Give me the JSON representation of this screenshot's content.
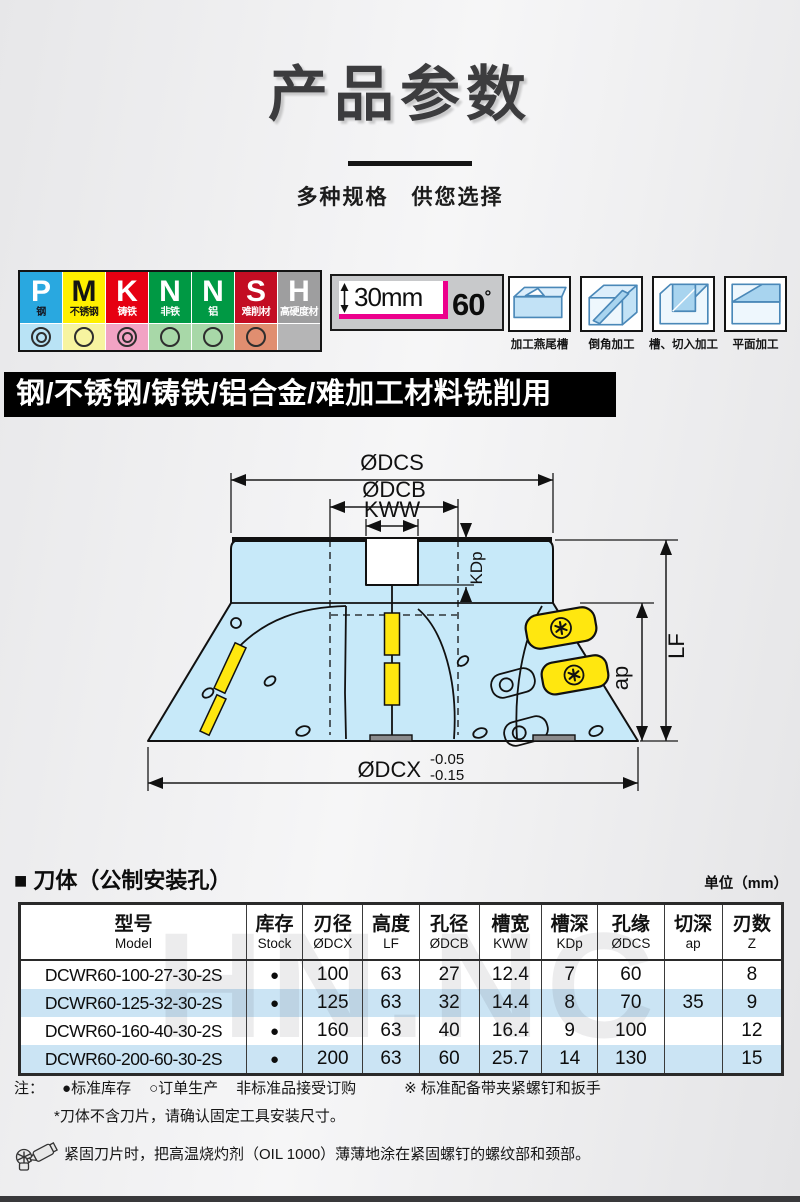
{
  "page": {
    "title": "产品参数",
    "subtitle": "多种规格　供您选择"
  },
  "material_badges": [
    {
      "letter": "P",
      "name": "钢",
      "color": "#29A8E0",
      "letter_color": "#ffffff",
      "name_color": "#14141e",
      "app_bg": "#B9E3F5",
      "mark": "double"
    },
    {
      "letter": "M",
      "name": "不锈钢",
      "color": "#FFF000",
      "letter_color": "#141414",
      "name_color": "#141414",
      "app_bg": "#F7F4A0",
      "mark": "single"
    },
    {
      "letter": "K",
      "name": "铸铁",
      "color": "#E60012",
      "letter_color": "#ffffff",
      "name_color": "#ffffff",
      "app_bg": "#F2A3C4",
      "mark": "double"
    },
    {
      "letter": "N",
      "name": "非铁",
      "color": "#009944",
      "letter_color": "#ffffff",
      "name_color": "#ffffff",
      "app_bg": "#A8D8A8",
      "mark": "single"
    },
    {
      "letter": "N",
      "name": "铝",
      "color": "#009944",
      "letter_color": "#ffffff",
      "name_color": "#ffffff",
      "app_bg": "#A8D8A8",
      "mark": "single"
    },
    {
      "letter": "S",
      "name": "难削材",
      "color": "#C30D23",
      "letter_color": "#ffffff",
      "name_color": "#ffffff",
      "app_bg": "#E08E70",
      "mark": "single"
    },
    {
      "letter": "H",
      "name": "高硬度材",
      "color": "#9E9E9F",
      "letter_color": "#ffffff",
      "name_color": "#ffffff",
      "app_bg": "#B5B5B6",
      "mark": "none"
    }
  ],
  "spec_box": {
    "height_label": "30mm",
    "angle_value": "60",
    "angle_unit": "°",
    "accent_color": "#EC008C"
  },
  "machining_icons": [
    {
      "label": "加工燕尾槽"
    },
    {
      "label": "倒角加工"
    },
    {
      "label": "槽、切入加工"
    },
    {
      "label": "平面加工"
    }
  ],
  "usage_banner": "钢/不锈钢/铸铁/铝合金/难加工材料铣削用",
  "diagram": {
    "labels": {
      "dcs": "ØDCS",
      "dcb": "ØDCB",
      "kww": "KWW",
      "kdp": "KDp",
      "lf": "LF",
      "ap": "ap",
      "dcx": "ØDCX",
      "dcx_tol_top": "-0.05",
      "dcx_tol_bottom": "-0.15"
    },
    "body_color": "#c7e9f9",
    "insert_color": "#ffe70f"
  },
  "table_section": {
    "heading": "■ 刀体（公制安装孔）",
    "unit": "单位（mm）"
  },
  "table": {
    "headers": [
      {
        "zh": "型号",
        "en": "Model"
      },
      {
        "zh": "库存",
        "en": "Stock"
      },
      {
        "zh": "刃径",
        "en": "ØDCX"
      },
      {
        "zh": "高度",
        "en": "LF"
      },
      {
        "zh": "孔径",
        "en": "ØDCB"
      },
      {
        "zh": "槽宽",
        "en": "KWW"
      },
      {
        "zh": "槽深",
        "en": "KDp"
      },
      {
        "zh": "孔缘",
        "en": "ØDCS"
      },
      {
        "zh": "切深",
        "en": "ap"
      },
      {
        "zh": "刃数",
        "en": "Z"
      }
    ],
    "rows": [
      {
        "model": "DCWR60-100-27-30-2S",
        "stock": "●",
        "dcx": "100",
        "lf": "63",
        "dcb": "27",
        "kww": "12.4",
        "kdp": "7",
        "dcs": "60",
        "ap": "",
        "z": "8"
      },
      {
        "model": "DCWR60-125-32-30-2S",
        "stock": "●",
        "dcx": "125",
        "lf": "63",
        "dcb": "32",
        "kww": "14.4",
        "kdp": "8",
        "dcs": "70",
        "ap": "35",
        "z": "9"
      },
      {
        "model": "DCWR60-160-40-30-2S",
        "stock": "●",
        "dcx": "160",
        "lf": "63",
        "dcb": "40",
        "kww": "16.4",
        "kdp": "9",
        "dcs": "100",
        "ap": "",
        "z": "12"
      },
      {
        "model": "DCWR60-200-60-30-2S",
        "stock": "●",
        "dcx": "200",
        "lf": "63",
        "dcb": "60",
        "kww": "25.7",
        "kdp": "14",
        "dcs": "130",
        "ap": "",
        "z": "15"
      }
    ],
    "alt_row_color": "#cbe4f4",
    "watermark": "HN.NC"
  },
  "notes": {
    "prefix": "注：",
    "legend_stock": "●标准库存",
    "legend_order": "○订单生产",
    "legend_custom": "非标准品接受订购",
    "legend_accessory": "※ 标准配备带夹紧螺钉和扳手",
    "line2": "*刀体不含刀片，请确认固定工具安装尺寸。",
    "line3": "紧固刀片时，把高温烧灼剂（OIL 1000）薄薄地涂在紧固螺钉的螺纹部和颈部。"
  }
}
